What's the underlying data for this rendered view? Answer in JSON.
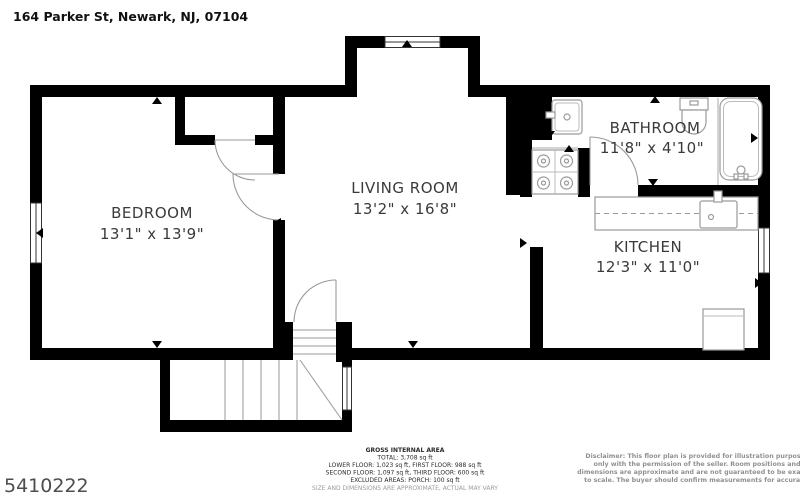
{
  "address": "164 Parker St, Newark, NJ, 07104",
  "listing_id": "5410222",
  "rooms": [
    {
      "name": "BEDROOM",
      "dims": "13'1\" x 13'9\""
    },
    {
      "name": "LIVING ROOM",
      "dims": "13'2\" x 16'8\""
    },
    {
      "name": "BATHROOM",
      "dims": "11'8\" x 4'10\""
    },
    {
      "name": "KITCHEN",
      "dims": "12'3\" x 11'0\""
    }
  ],
  "area_summary": {
    "title": "GROSS INTERNAL AREA",
    "total": "TOTAL: 3,708 sq ft",
    "floors1": "LOWER FLOOR: 1,023 sq ft, FIRST FLOOR: 988 sq ft",
    "floors2": "SECOND FLOOR: 1,097 sq ft, THIRD FLOOR: 600 sq ft",
    "excluded": "EXCLUDED AREAS: PORCH: 100 sq ft",
    "note": "SIZE AND DIMENSIONS ARE APPROXIMATE, ACTUAL MAY VARY"
  },
  "disclaimer": {
    "line1": "Disclaimer: This floor plan is provided for illustration purposes",
    "line2": "only with the permission of the seller. Room positions and",
    "line3": "dimensions are approximate and are not guaranteed to be exact or",
    "line4": "to scale. The buyer should confirm measurements for accuracy."
  },
  "colors": {
    "wall": "#000000",
    "fixture": "#9a9a9a",
    "text": "#3a3a3a",
    "muted": "#909090"
  }
}
